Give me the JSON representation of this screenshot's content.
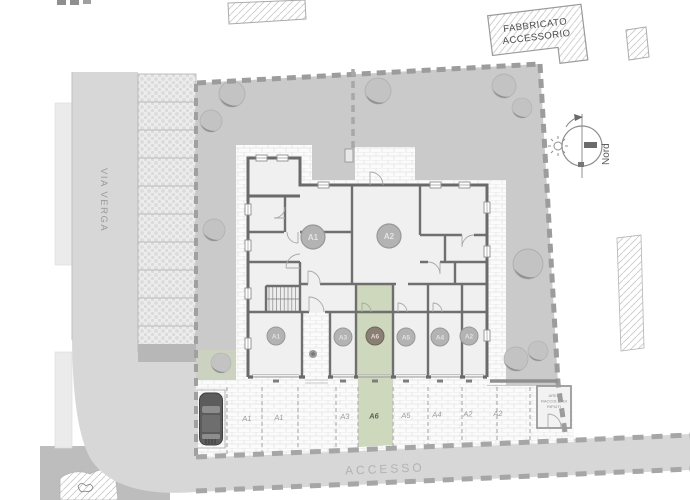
{
  "labels": {
    "street": "VIA VERGA",
    "access_road": "ACCESSO",
    "north": "Nord",
    "accessory_building_line1": "FABBRICATO",
    "accessory_building_line2": "ACCESSORIO",
    "waste_area_line1": "AREA",
    "waste_area_line2": "RACCOLTA DI",
    "waste_area_line3": "RIFIUTI"
  },
  "apartments": [
    {
      "id": "A1"
    },
    {
      "id": "A2"
    }
  ],
  "garages": [
    {
      "id": "A1"
    },
    {
      "id": "A3"
    },
    {
      "id": "A6",
      "highlighted": true
    },
    {
      "id": "A5"
    },
    {
      "id": "A4"
    },
    {
      "id": "A2"
    }
  ],
  "parking": [
    "A1",
    "A1",
    "A3",
    "A6",
    "A5",
    "A4",
    "A2",
    "A2"
  ],
  "colors": {
    "highlight_unit": "#cdd8bd",
    "highlight_badge": "#8a7f74",
    "garden": "#cacaca",
    "road": "#d7d7d7",
    "wall": "#6a6a6a",
    "badge": "#b3b3b3"
  }
}
